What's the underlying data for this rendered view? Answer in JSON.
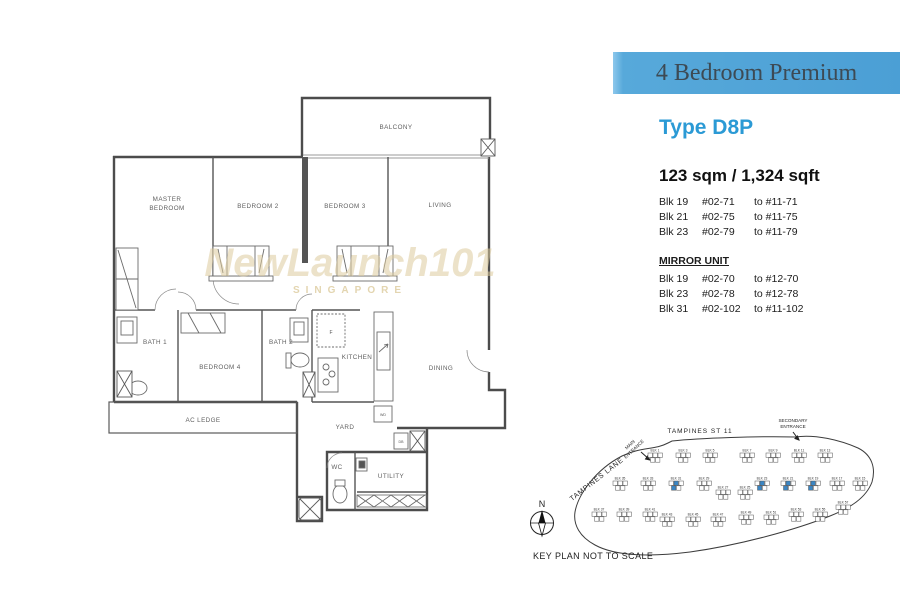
{
  "colors": {
    "banner_blue": "#4b9fd5",
    "banner_blue_light": "#8dc8ec",
    "type_blue": "#2b9ad5",
    "block_highlight": "#3b86c4"
  },
  "banner": {
    "title": "4 Bedroom Premium"
  },
  "panel": {
    "type": "Type D8P",
    "area": "123 sqm / 1,324 sqft",
    "units": [
      {
        "blk": "Blk 19",
        "from": "#02-71",
        "to": "to #11-71"
      },
      {
        "blk": "Blk 21",
        "from": "#02-75",
        "to": "to #11-75"
      },
      {
        "blk": "Blk 23",
        "from": "#02-79",
        "to": "to #11-79"
      }
    ],
    "mirror_heading": "MIRROR UNIT",
    "mirror_units": [
      {
        "blk": "Blk 19",
        "from": "#02-70",
        "to": "to #12-70"
      },
      {
        "blk": "Blk 23",
        "from": "#02-78",
        "to": "to #12-78"
      },
      {
        "blk": "Blk 31",
        "from": "#02-102",
        "to": "to #11-102"
      }
    ]
  },
  "watermark": {
    "line1": "NewLaunch101",
    "line2": "SINGAPORE"
  },
  "floorplan": {
    "rooms": {
      "master_line1": "MASTER",
      "master_line2": "BEDROOM",
      "bedroom2": "BEDROOM 2",
      "bedroom3": "BEDROOM 3",
      "living": "LIVING",
      "balcony": "BALCONY",
      "bath1": "BATH 1",
      "bedroom4": "BEDROOM 4",
      "bath2": "BATH 2",
      "kitchen": "KITCHEN",
      "dining": "DINING",
      "ac_ledge": "AC LEDGE",
      "yard": "YARD",
      "wc": "WC",
      "utility": "UTILITY"
    },
    "fixtures": {
      "fridge": "F",
      "washer": "WD",
      "db": "DB"
    }
  },
  "keyplan": {
    "street": "TAMPINES ST 11",
    "lane": "TAMPINES LANE",
    "secondary_entrance_1": "SECONDARY",
    "secondary_entrance_2": "ENTRANCE",
    "main_entrance_1": "MAIN",
    "main_entrance_2": "ENTRANCE",
    "compass_n": "N",
    "note": "KEY PLAN NOT TO SCALE",
    "blocks": [
      {
        "label": "BLK 1",
        "x": 648,
        "y": 453
      },
      {
        "label": "BLK 3",
        "x": 676,
        "y": 453
      },
      {
        "label": "BLK 5",
        "x": 703,
        "y": 453
      },
      {
        "label": "BLK 7",
        "x": 740,
        "y": 453
      },
      {
        "label": "BLK 9",
        "x": 766,
        "y": 453
      },
      {
        "label": "BLK 11",
        "x": 792,
        "y": 453
      },
      {
        "label": "BLK 13",
        "x": 818,
        "y": 453
      },
      {
        "label": "BLK 35",
        "x": 613,
        "y": 481
      },
      {
        "label": "BLK 33",
        "x": 641,
        "y": 481
      },
      {
        "label": "BLK 31",
        "x": 669,
        "y": 481,
        "hl": true
      },
      {
        "label": "BLK 29",
        "x": 697,
        "y": 481
      },
      {
        "label": "BLK 27",
        "x": 716,
        "y": 490
      },
      {
        "label": "BLK 25",
        "x": 738,
        "y": 490
      },
      {
        "label": "BLK 23",
        "x": 755,
        "y": 481,
        "hl": true
      },
      {
        "label": "BLK 21",
        "x": 781,
        "y": 481,
        "hl": true
      },
      {
        "label": "BLK 19",
        "x": 806,
        "y": 481,
        "hl": true
      },
      {
        "label": "BLK 17",
        "x": 830,
        "y": 481
      },
      {
        "label": "BLK 15",
        "x": 853,
        "y": 481
      },
      {
        "label": "BLK 37",
        "x": 592,
        "y": 512
      },
      {
        "label": "BLK 39",
        "x": 617,
        "y": 512
      },
      {
        "label": "BLK 41",
        "x": 643,
        "y": 512
      },
      {
        "label": "BLK 43",
        "x": 660,
        "y": 517
      },
      {
        "label": "BLK 45",
        "x": 686,
        "y": 517
      },
      {
        "label": "BLK 47",
        "x": 711,
        "y": 517
      },
      {
        "label": "BLK 49",
        "x": 739,
        "y": 515
      },
      {
        "label": "BLK 51",
        "x": 764,
        "y": 515
      },
      {
        "label": "BLK 53",
        "x": 789,
        "y": 512
      },
      {
        "label": "BLK 55",
        "x": 813,
        "y": 512
      },
      {
        "label": "BLK 57",
        "x": 836,
        "y": 505
      }
    ]
  }
}
